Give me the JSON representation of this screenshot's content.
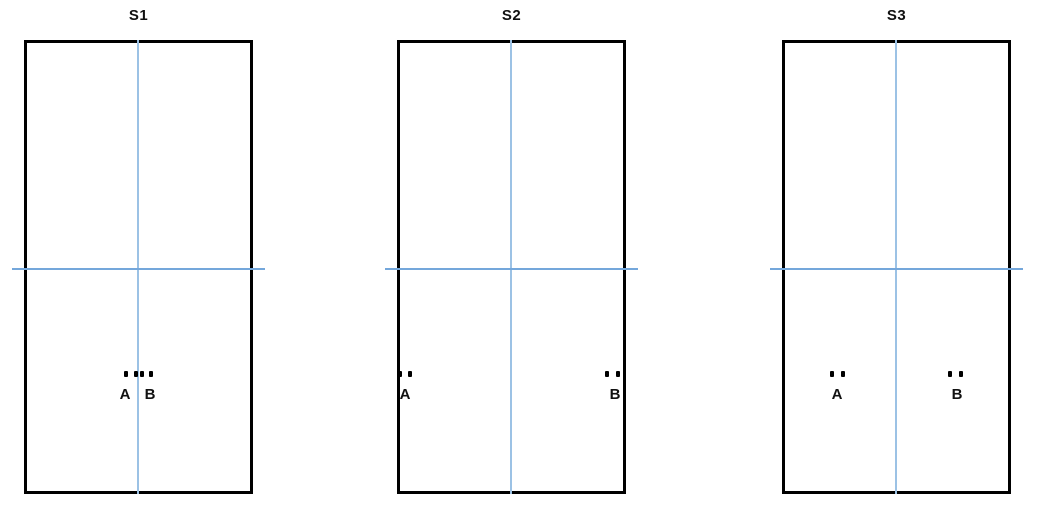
{
  "figure": {
    "background_color": "#ffffff",
    "wall_color": "#000000",
    "centerline_color": "#9cc2e5",
    "crossline_color": "#74a7db",
    "point_color": "#000000",
    "panels": [
      {
        "title": "S1",
        "centerline_x_fraction": 0.5,
        "crossline_y_fraction": 0.5,
        "points": [
          {
            "label": "A",
            "x_fraction": 0.45,
            "y_fraction": 0.74
          },
          {
            "label": "B",
            "x_fraction": 0.55,
            "y_fraction": 0.74
          }
        ]
      },
      {
        "title": "S2",
        "centerline_x_fraction": 0.5,
        "crossline_y_fraction": 0.5,
        "points": [
          {
            "label": "A",
            "x_fraction": 0.03,
            "y_fraction": 0.74
          },
          {
            "label": "B",
            "x_fraction": 0.94,
            "y_fraction": 0.74
          }
        ]
      },
      {
        "title": "S3",
        "centerline_x_fraction": 0.5,
        "crossline_y_fraction": 0.5,
        "points": [
          {
            "label": "A",
            "x_fraction": 0.25,
            "y_fraction": 0.74
          },
          {
            "label": "B",
            "x_fraction": 0.76,
            "y_fraction": 0.74
          }
        ]
      }
    ]
  }
}
